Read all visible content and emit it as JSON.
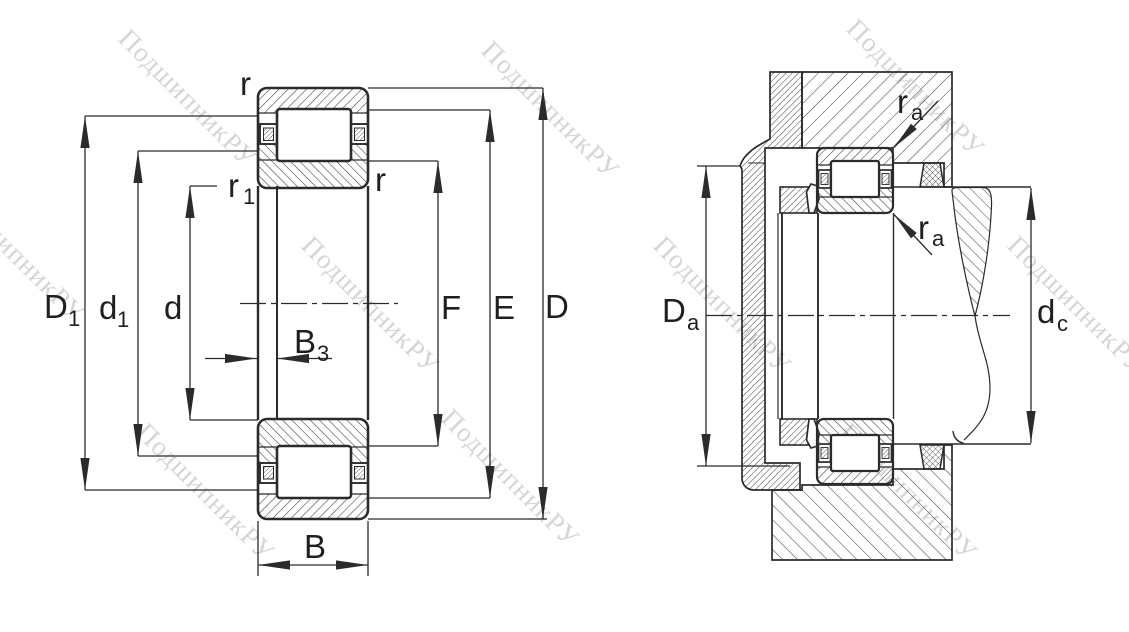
{
  "drawing_title": "",
  "watermark": {
    "text": "ПодшипникРУ",
    "color": "#b3b3b3"
  },
  "colors": {
    "line": "#2b2b2b",
    "hatch": "#404040",
    "background": "#ffffff"
  },
  "labels": {
    "D1": {
      "main": "D",
      "sub": "1"
    },
    "d1": {
      "main": "d",
      "sub": "1"
    },
    "d": {
      "main": "d"
    },
    "B3": {
      "main": "B",
      "sub": "3"
    },
    "B": {
      "main": "B"
    },
    "F": {
      "main": "F"
    },
    "E": {
      "main": "E"
    },
    "D": {
      "main": "D"
    },
    "r_outer_top": {
      "main": "r"
    },
    "r1_inner": {
      "main": "r",
      "sub": "1"
    },
    "r_inner_right": {
      "main": "r"
    },
    "Da": {
      "main": "D",
      "sub": "a"
    },
    "dc": {
      "main": "d",
      "sub": "c"
    },
    "ra_top": {
      "main": "r",
      "sub": "a"
    },
    "ra_bottom": {
      "main": "r",
      "sub": "a"
    }
  }
}
